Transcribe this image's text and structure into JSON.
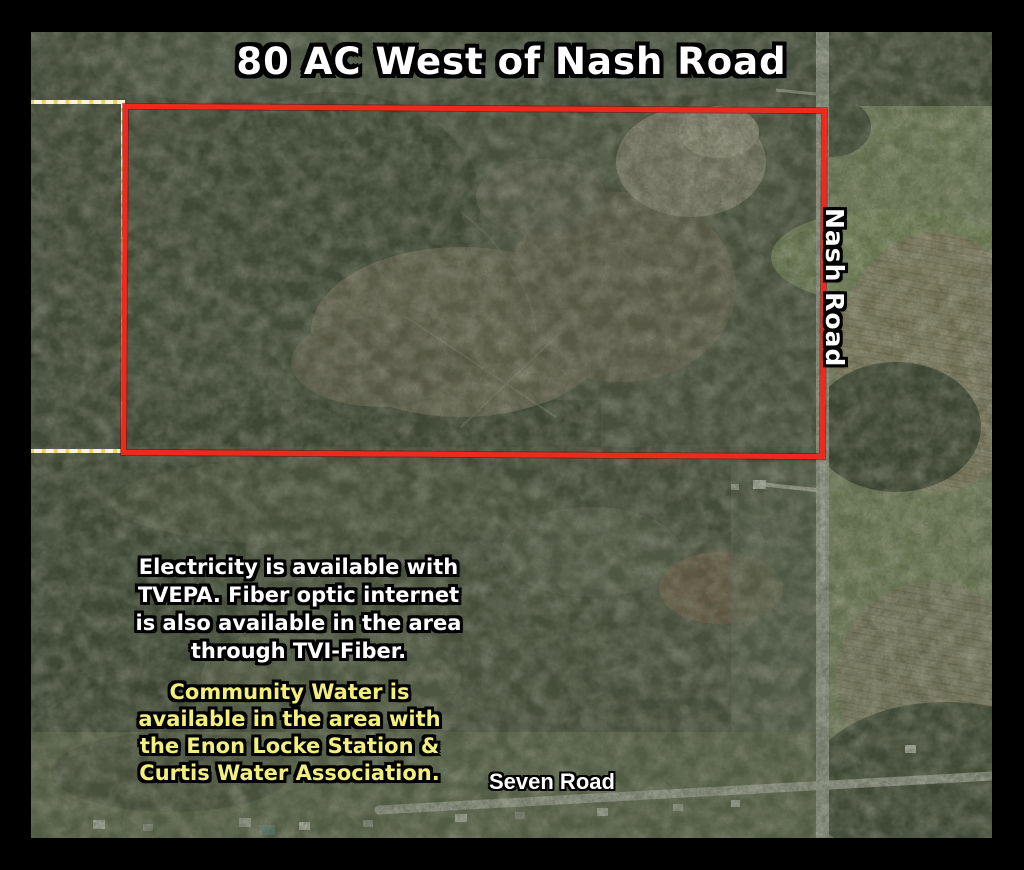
{
  "title": "80 AC West of Nash Road",
  "labels": {
    "nash_road": "Nash Road",
    "seven_road": "Seven Road"
  },
  "notes": {
    "electricity_lines": [
      "Electricity is available with",
      "TVEPA. Fiber optic internet",
      "is also available in the area",
      "through TVI-Fiber."
    ],
    "water_lines": [
      "Community Water is",
      "available in the area with",
      "the Enon Locke Station &",
      "Curtis Water Association."
    ]
  },
  "boundaries": {
    "subject_parcel": {
      "acreage": "80 AC",
      "outline_color": "#ee2a1c"
    },
    "adjacent_parcel": {
      "outline_color": "#ecd05c"
    }
  },
  "colors": {
    "frame": "#000000",
    "title_text": "#ffffff",
    "electricity_text": "#ffffff",
    "water_text": "#f2ef7d",
    "text_outline": "#000000",
    "road_surface": "#a2a498"
  }
}
